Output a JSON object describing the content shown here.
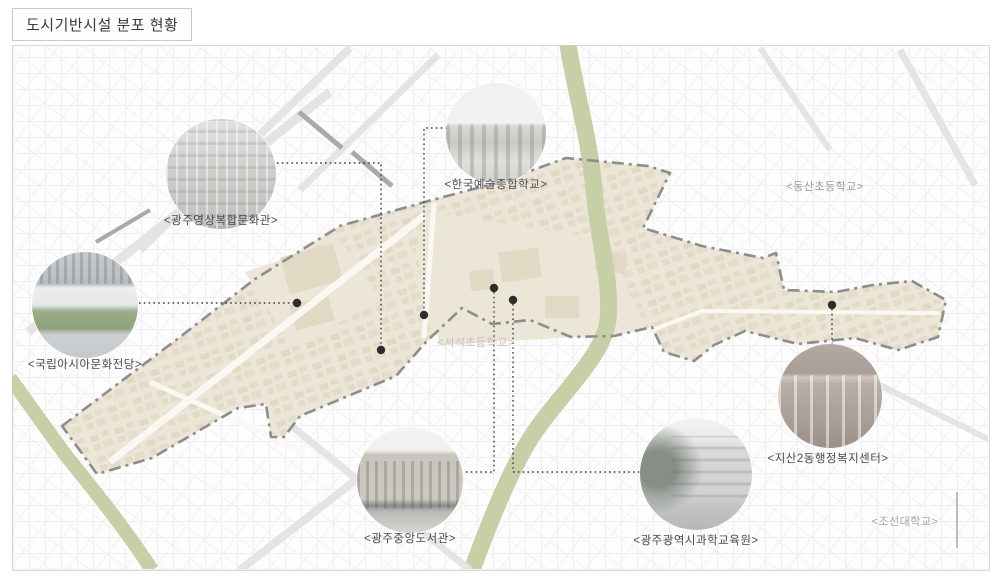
{
  "title": "도시기반시설 분포 현황",
  "facilities": [
    {
      "id": "gwangju-media-art-center",
      "label": "<광주영상복합문화관>"
    },
    {
      "id": "korea-national-univ-arts",
      "label": "<한국예술종합학교>"
    },
    {
      "id": "asia-culture-center",
      "label": "<국립아시아문화전당>"
    },
    {
      "id": "gwangju-central-library",
      "label": "<광주중앙도서관>"
    },
    {
      "id": "gwangju-science-institute",
      "label": "<광주광역시과학교육원>"
    },
    {
      "id": "jisan2-dong-welfare-center",
      "label": "<지산2동행정복지센터>"
    }
  ],
  "map_labels": [
    {
      "id": "dongsan-elementary",
      "label": "<동산초등학교>"
    },
    {
      "id": "seoseok-elementary",
      "label": "<서석초등학교>"
    },
    {
      "id": "chosun-university",
      "label": "<조선대학교>"
    }
  ],
  "colors": {
    "district_fill": "#ece6d8",
    "district_building": "#ddd2bc",
    "district_border": "#8d8d8d",
    "greenway": "#c6cfa6",
    "marker_dot": "#2d2d2d",
    "leader_line": "#3c3c3c",
    "map_background": "#fdfdfd"
  }
}
